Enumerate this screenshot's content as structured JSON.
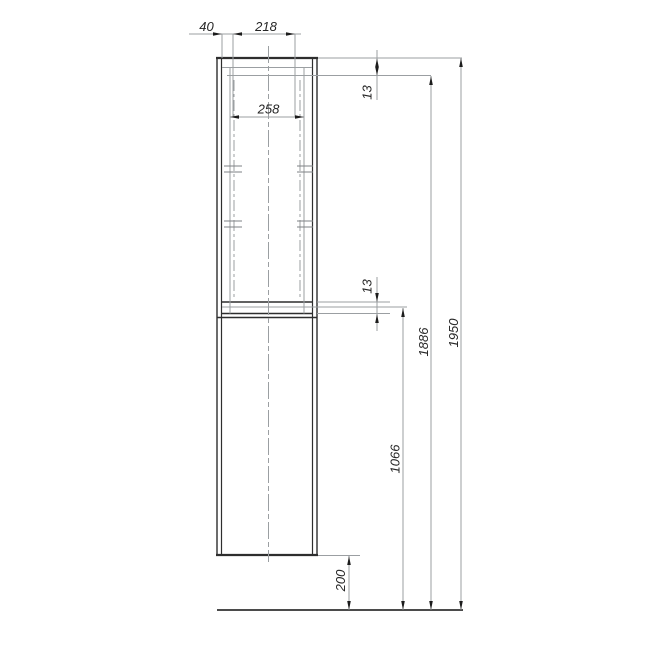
{
  "drawing": {
    "kind": "furniture-elevation-technical-drawing",
    "labels": {
      "back_offset": "40",
      "front_depth": "218",
      "inner_width": "258",
      "top_panel_thickness": "13",
      "shelf_thickness": "13",
      "door_section_height": "1066",
      "inner_height": "1886",
      "total_height": "1950",
      "floor_clearance": "200"
    },
    "colors": {
      "outline": "#2e2e2e",
      "thin_line": "#9b9fa2",
      "marker_line": "#7e8284",
      "floor_line": "#4b4b4b",
      "arrow": "#1c1c1c",
      "text": "#262626",
      "background": "#ffffff"
    }
  }
}
